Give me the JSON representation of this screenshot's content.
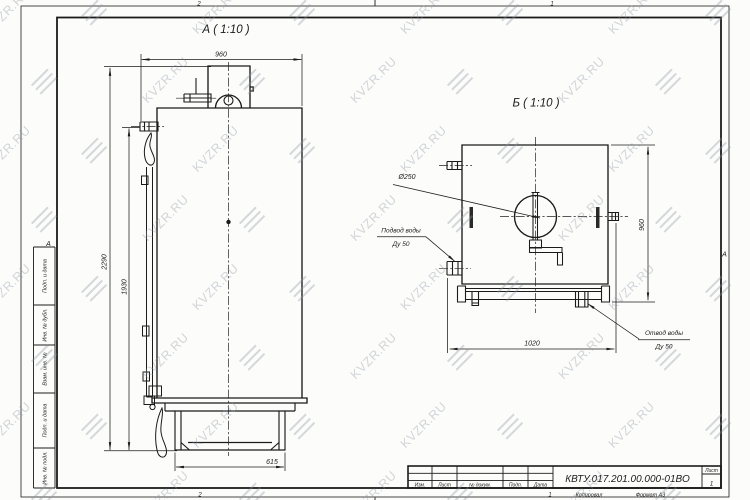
{
  "watermark": {
    "text": "KVZR.RU"
  },
  "frame": {
    "zone_top_left": "2",
    "zone_top_right": "1",
    "zone_bottom_left": "2",
    "zone_bottom_right": "1",
    "zone_row_left": "А",
    "zone_row_right": "А",
    "margin_cells": [
      "Подп. и дата",
      "Инв. № дубл.",
      "Взам. инв. №",
      "Подп. и дата",
      "Инв. № подл."
    ]
  },
  "title_block": {
    "designation": "КВТУ.017.201.00.000-01ВО",
    "col_izm": "Изм.",
    "col_list": "Лист",
    "col_doc": "№ докум.",
    "col_podp": "Подп.",
    "col_data": "Дата",
    "sheet_label": "Лист",
    "sheet_number": "1",
    "copied": "Копировал",
    "format": "Формат А3"
  },
  "view_a": {
    "title": "А ( 1:10 )",
    "dim_width": "960",
    "dim_height_overall": "2290",
    "dim_height_body": "1930",
    "dim_base": "615"
  },
  "view_b": {
    "title": "Б ( 1:10 )",
    "dim_diameter": "Ø250",
    "dim_height": "960",
    "dim_width": "1020",
    "inlet_line1": "Подвод воды",
    "inlet_line2": "Ду 50",
    "outlet_line1": "Отвод воды",
    "outlet_line2": "Ду 50"
  }
}
